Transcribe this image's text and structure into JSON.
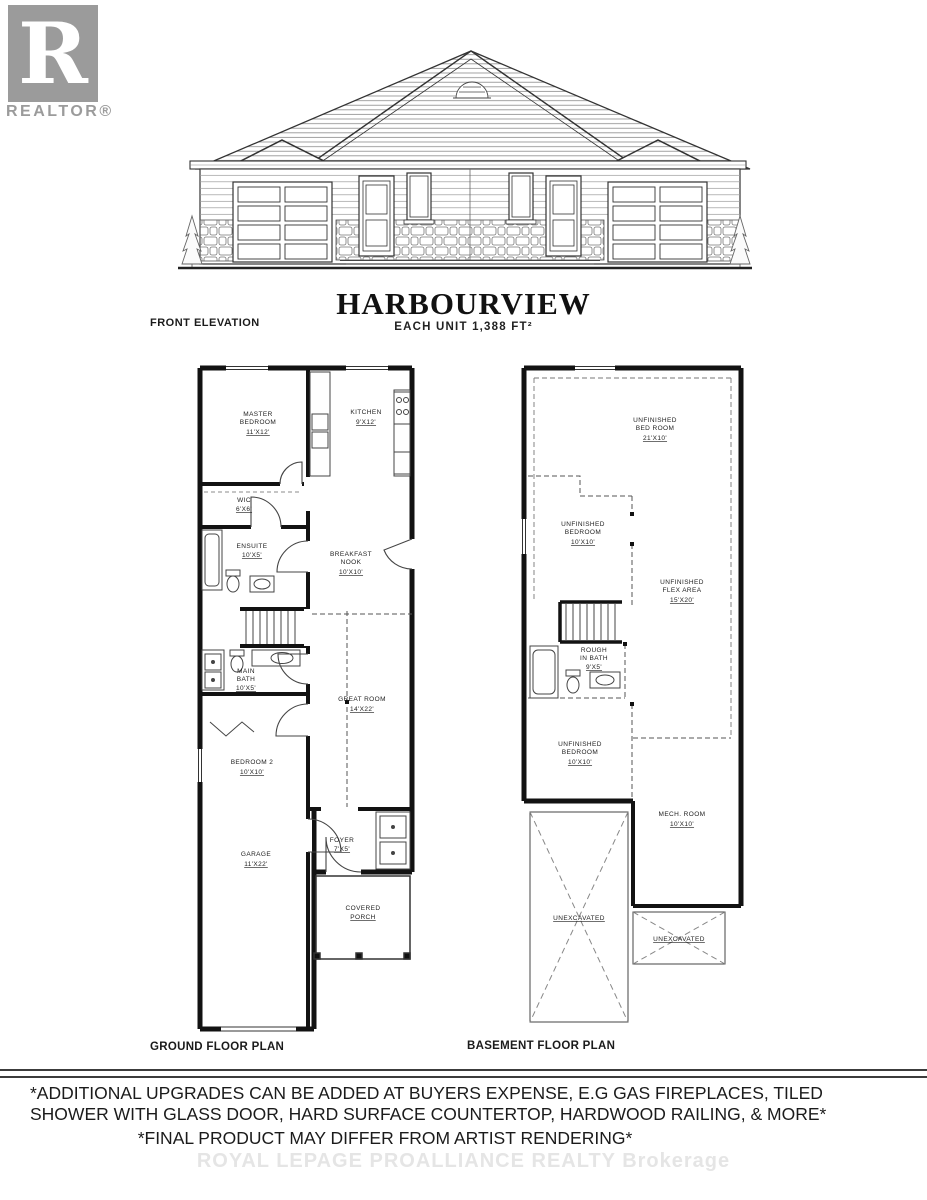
{
  "logo": {
    "letter": "R",
    "label": "REALTOR®",
    "gray": "#9b9b9b"
  },
  "title_block": {
    "title": "HARBOURVIEW",
    "subtitle": "EACH UNIT 1,388 FT²",
    "elevation_caption": "FRONT ELEVATION"
  },
  "plans": {
    "ground": {
      "caption": "GROUND FLOOR PLAN",
      "rooms": {
        "master": {
          "l1": "MASTER",
          "l2": "BEDROOM",
          "dim": "11'X12'"
        },
        "kitchen": {
          "l1": "KITCHEN",
          "dim": "9'X12'"
        },
        "wic": {
          "l1": "WIC",
          "dim": "6'X6'"
        },
        "ensuite": {
          "l1": "ENSUITE",
          "dim": "10'X5'"
        },
        "breakfast": {
          "l1": "BREAKFAST",
          "l2": "NOOK",
          "dim": "10'X10'"
        },
        "great_room": {
          "l1": "GREAT ROOM",
          "dim": "14'X22'"
        },
        "main_bath": {
          "l1": "MAIN",
          "l2": "BATH",
          "dim": "10'X5'"
        },
        "bedroom2": {
          "l1": "BEDROOM 2",
          "dim": "10'X10'"
        },
        "garage": {
          "l1": "GARAGE",
          "dim": "11'X22'"
        },
        "foyer": {
          "l1": "FOYER",
          "dim": "7'X5'"
        },
        "porch": {
          "l1": "COVERED",
          "l2": "PORCH"
        }
      }
    },
    "basement": {
      "caption": "BASEMENT FLOOR PLAN",
      "rooms": {
        "bed_top": {
          "l1": "UNFINISHED",
          "l2": "BED ROOM",
          "dim": "21'X10'"
        },
        "bed_mid": {
          "l1": "UNFINISHED",
          "l2": "BEDROOM",
          "dim": "10'X10'"
        },
        "flex": {
          "l1": "UNFINISHED",
          "l2": "FLEX AREA",
          "dim": "15'X20'"
        },
        "bath": {
          "l1": "ROUGH",
          "l2": "IN BATH",
          "dim": "9'X5'"
        },
        "bed_low": {
          "l1": "UNFINISHED",
          "l2": "BEDROOM",
          "dim": "10'X10'"
        },
        "mech": {
          "l1": "MECH. ROOM",
          "dim": "10'X10'"
        },
        "unex1": {
          "l1": "UNEXCAVATED"
        },
        "unex2": {
          "l1": "UNEXCAVATED"
        }
      }
    }
  },
  "footer": {
    "disclaimer_line1": "*ADDITIONAL UPGRADES CAN BE ADDED AT BUYERS EXPENSE, E.G GAS FIREPLACES, TILED",
    "disclaimer_line2": "SHOWER WITH GLASS DOOR, HARD SURFACE COUNTERTOP, HARDWOOD RAILING, & MORE*",
    "final_note": "*FINAL PRODUCT MAY DIFFER FROM ARTIST RENDERING*",
    "watermark": "ROYAL LEPAGE PROALLIANCE REALTY Brokerage"
  },
  "colors": {
    "ink": "#2b2b2b",
    "wall": "#121212",
    "watermark_gray": "#e5e5e5"
  }
}
